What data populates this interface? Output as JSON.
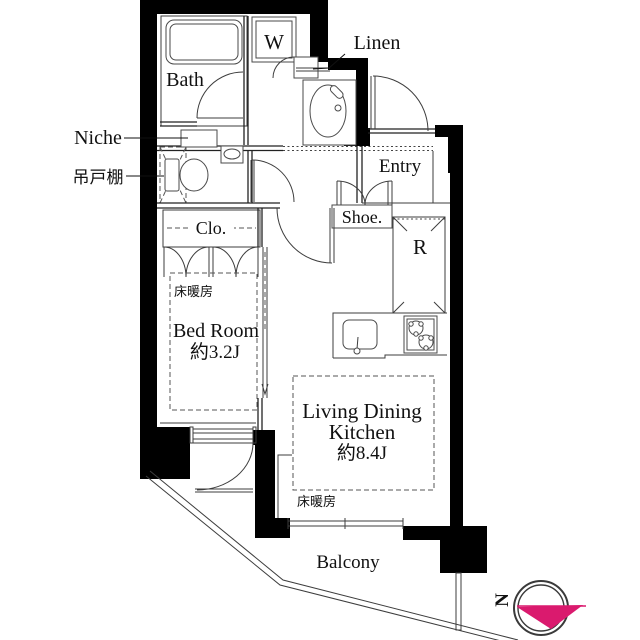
{
  "plan": {
    "labels": {
      "bath": "Bath",
      "washer": "W",
      "linen": "Linen",
      "niche": "Niche",
      "hanging_cupboard": "吊戸棚",
      "entry": "Entry",
      "shoe": "Shoe.",
      "refrigerator": "R",
      "closet": "Clo.",
      "bedroom_floor_heating": "床暖房",
      "bedroom_name": "Bed Room",
      "bedroom_size": "約3.2J",
      "ldk_line1": "Living Dining",
      "ldk_line2": "Kitchen",
      "ldk_size": "約8.4J",
      "ldk_floor_heating": "床暖房",
      "balcony": "Balcony",
      "compass_north": "N"
    },
    "colors": {
      "wall": "#000000",
      "line": "#3d3d3d",
      "accent_pink": "#da1a6e",
      "background": "#ffffff"
    }
  }
}
